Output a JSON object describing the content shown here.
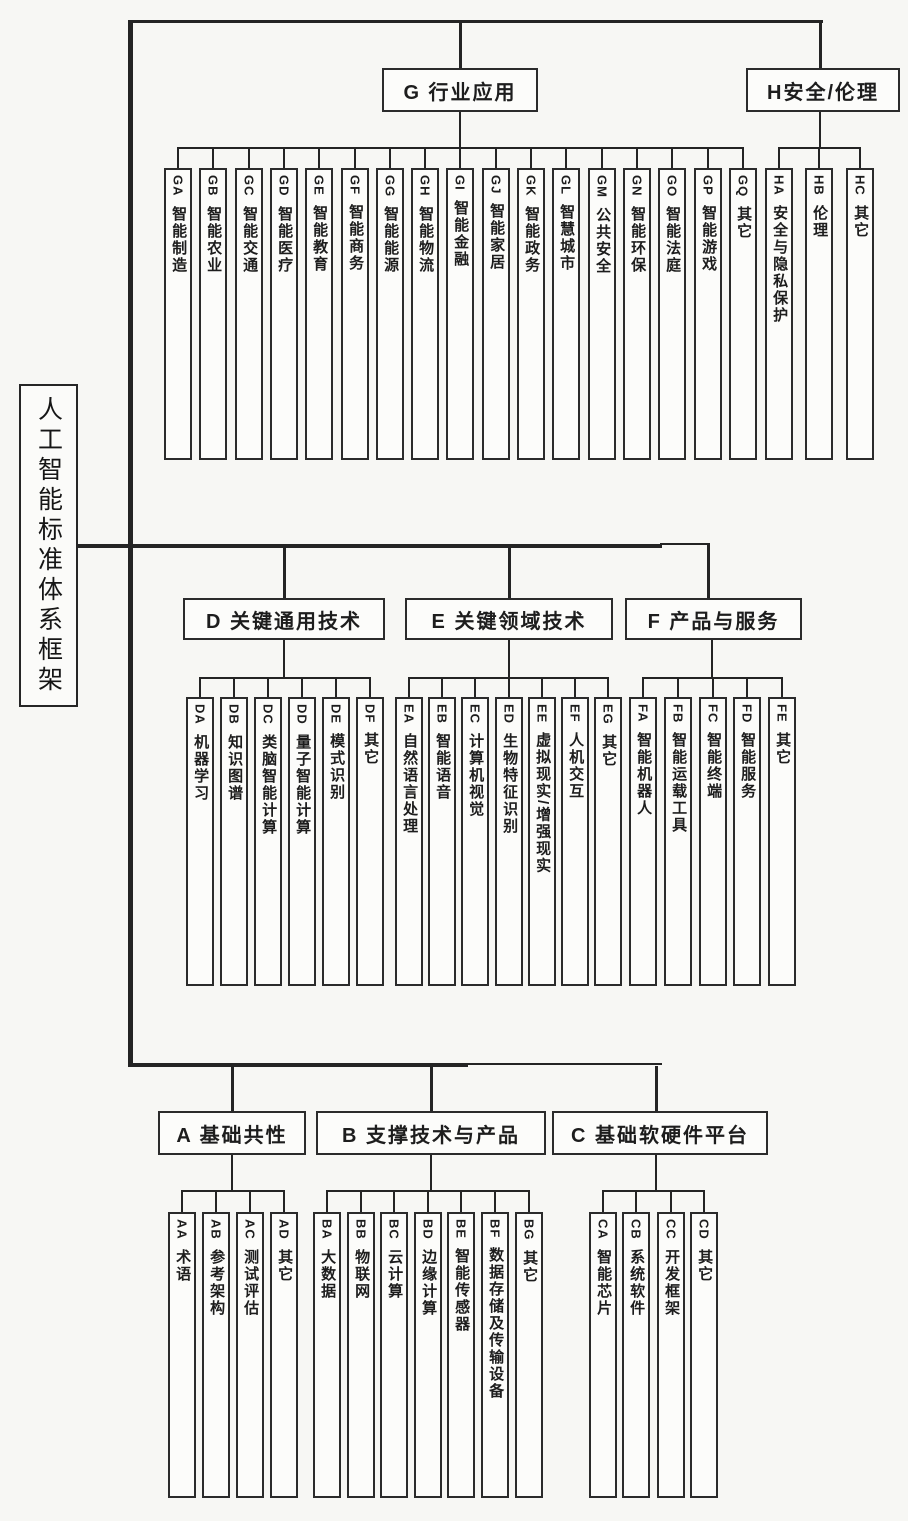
{
  "title": "人工智能标准体系框架",
  "colors": {
    "ink": "#242424",
    "paper": "#f7f7f4",
    "box_fill": "#fcfcfa"
  },
  "sections": [
    {
      "id": "G",
      "label": "G 行业应用",
      "children": [
        {
          "code": "GA",
          "name": "智能制造"
        },
        {
          "code": "GB",
          "name": "智能农业"
        },
        {
          "code": "GC",
          "name": "智能交通"
        },
        {
          "code": "GD",
          "name": "智能医疗"
        },
        {
          "code": "GE",
          "name": "智能教育"
        },
        {
          "code": "GF",
          "name": "智能商务"
        },
        {
          "code": "GG",
          "name": "智能能源"
        },
        {
          "code": "GH",
          "name": "智能物流"
        },
        {
          "code": "GI",
          "name": "智能金融"
        },
        {
          "code": "GJ",
          "name": "智能家居"
        },
        {
          "code": "GK",
          "name": "智能政务"
        },
        {
          "code": "GL",
          "name": "智慧城市"
        },
        {
          "code": "GM",
          "name": "公共安全"
        },
        {
          "code": "GN",
          "name": "智能环保"
        },
        {
          "code": "GO",
          "name": "智能法庭"
        },
        {
          "code": "GP",
          "name": "智能游戏"
        },
        {
          "code": "GQ",
          "name": "其它"
        }
      ]
    },
    {
      "id": "H",
      "label": "H安全/伦理",
      "children": [
        {
          "code": "HA",
          "name": "安全与隐私保护"
        },
        {
          "code": "HB",
          "name": "伦理"
        },
        {
          "code": "HC",
          "name": "其它"
        }
      ]
    },
    {
      "id": "D",
      "label": "D 关键通用技术",
      "children": [
        {
          "code": "DA",
          "name": "机器学习"
        },
        {
          "code": "DB",
          "name": "知识图谱"
        },
        {
          "code": "DC",
          "name": "类脑智能计算"
        },
        {
          "code": "DD",
          "name": "量子智能计算"
        },
        {
          "code": "DE",
          "name": "模式识别"
        },
        {
          "code": "DF",
          "name": "其它"
        }
      ]
    },
    {
      "id": "E",
      "label": "E 关键领域技术",
      "children": [
        {
          "code": "EA",
          "name": "自然语言处理"
        },
        {
          "code": "EB",
          "name": "智能语音"
        },
        {
          "code": "EC",
          "name": "计算机视觉"
        },
        {
          "code": "ED",
          "name": "生物特征识别"
        },
        {
          "code": "EE",
          "name": "虚拟现实/增强现实"
        },
        {
          "code": "EF",
          "name": "人机交互"
        },
        {
          "code": "EG",
          "name": "其它"
        }
      ]
    },
    {
      "id": "F",
      "label": "F 产品与服务",
      "children": [
        {
          "code": "FA",
          "name": "智能机器人"
        },
        {
          "code": "FB",
          "name": "智能运载工具"
        },
        {
          "code": "FC",
          "name": "智能终端"
        },
        {
          "code": "FD",
          "name": "智能服务"
        },
        {
          "code": "FE",
          "name": "其它"
        }
      ]
    },
    {
      "id": "A",
      "label": "A 基础共性",
      "children": [
        {
          "code": "AA",
          "name": "术语"
        },
        {
          "code": "AB",
          "name": "参考架构"
        },
        {
          "code": "AC",
          "name": "测试评估"
        },
        {
          "code": "AD",
          "name": "其它"
        }
      ]
    },
    {
      "id": "B",
      "label": "B 支撑技术与产品",
      "children": [
        {
          "code": "BA",
          "name": "大数据"
        },
        {
          "code": "BB",
          "name": "物联网"
        },
        {
          "code": "BC",
          "name": "云计算"
        },
        {
          "code": "BD",
          "name": "边缘计算"
        },
        {
          "code": "BE",
          "name": "智能传感器"
        },
        {
          "code": "BF",
          "name": "数据存储及传输设备"
        },
        {
          "code": "BG",
          "name": "其它"
        }
      ]
    },
    {
      "id": "C",
      "label": "C 基础软硬件平台",
      "children": [
        {
          "code": "CA",
          "name": "智能芯片"
        },
        {
          "code": "CB",
          "name": "系统软件"
        },
        {
          "code": "CC",
          "name": "开发框架"
        },
        {
          "code": "CD",
          "name": "其它"
        }
      ]
    }
  ]
}
